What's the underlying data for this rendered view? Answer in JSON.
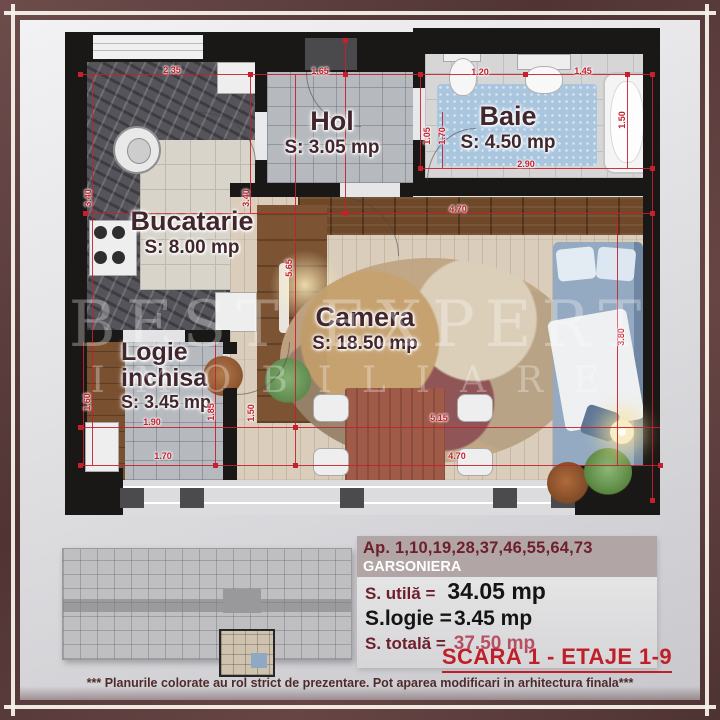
{
  "colors": {
    "frame": "#5d3e3e",
    "wall": "#1a1816",
    "dimension_red": "#c4202e",
    "label_maroon": "#42262e",
    "info_band": "#b2a5a5",
    "info_band_text": "#6d1f2c",
    "total_value_red": "#b55163",
    "scara_red": "#c01f2a"
  },
  "watermark": {
    "line1": "BEST EXPERT",
    "line2": "IMOBILIARE"
  },
  "plan": {
    "rooms": [
      {
        "name": "Bucatarie",
        "area": "S: 8.00 mp"
      },
      {
        "name": "Hol",
        "area": "S: 3.05 mp"
      },
      {
        "name": "Baie",
        "area": "S: 4.50 mp"
      },
      {
        "name": "Camera",
        "area": "S: 18.50 mp"
      },
      {
        "name": "Logie\ninchisa",
        "area": "S: 3.45 mp"
      }
    ],
    "dimensions": [
      {
        "value": "2.35",
        "x": 107,
        "y": 42,
        "vertical": false
      },
      {
        "value": "1.65",
        "x": 255,
        "y": 43,
        "vertical": false
      },
      {
        "value": "1.20",
        "x": 415,
        "y": 44,
        "vertical": false
      },
      {
        "value": "1.45",
        "x": 518,
        "y": 43,
        "vertical": false
      },
      {
        "value": "2.90",
        "x": 461,
        "y": 136,
        "vertical": false
      },
      {
        "value": "4.70",
        "x": 393,
        "y": 181,
        "vertical": false
      },
      {
        "value": "5.15",
        "x": 374,
        "y": 390,
        "vertical": false
      },
      {
        "value": "4.70",
        "x": 392,
        "y": 428,
        "vertical": false
      },
      {
        "value": "1.90",
        "x": 87,
        "y": 394,
        "vertical": false
      },
      {
        "value": "1.70",
        "x": 98,
        "y": 428,
        "vertical": false
      },
      {
        "value": "3.40",
        "x": 23,
        "y": 170,
        "vertical": true
      },
      {
        "value": "3.40",
        "x": 181,
        "y": 170,
        "vertical": true
      },
      {
        "value": "1.05",
        "x": 362,
        "y": 108,
        "vertical": true
      },
      {
        "value": "1.70",
        "x": 377,
        "y": 108,
        "vertical": true
      },
      {
        "value": "1.50",
        "x": 557,
        "y": 92,
        "vertical": true
      },
      {
        "value": "1.50",
        "x": 186,
        "y": 385,
        "vertical": true
      },
      {
        "value": "1.85",
        "x": 146,
        "y": 384,
        "vertical": true
      },
      {
        "value": "1.60",
        "x": 22,
        "y": 374,
        "vertical": true
      },
      {
        "value": "3.80",
        "x": 556,
        "y": 309,
        "vertical": true
      },
      {
        "value": "5.65",
        "x": 224,
        "y": 240,
        "vertical": true
      }
    ]
  },
  "info_panel": {
    "apartments": "Ap. 1,10,19,28,37,46,55,64,73",
    "unit_type": "GARSONIERA",
    "rows": [
      {
        "label": "S. utilă =",
        "value": "34.05 mp"
      },
      {
        "label": "S.logie =",
        "value": "3.45 mp"
      },
      {
        "label": "S. totală =",
        "value": "37.50 mp"
      }
    ],
    "scara": "SCARA 1 - ETAJE 1-9",
    "disclaimer": "*** Planurile colorate au rol strict de prezentare. Pot aparea modificari in arhitectura finala***"
  }
}
